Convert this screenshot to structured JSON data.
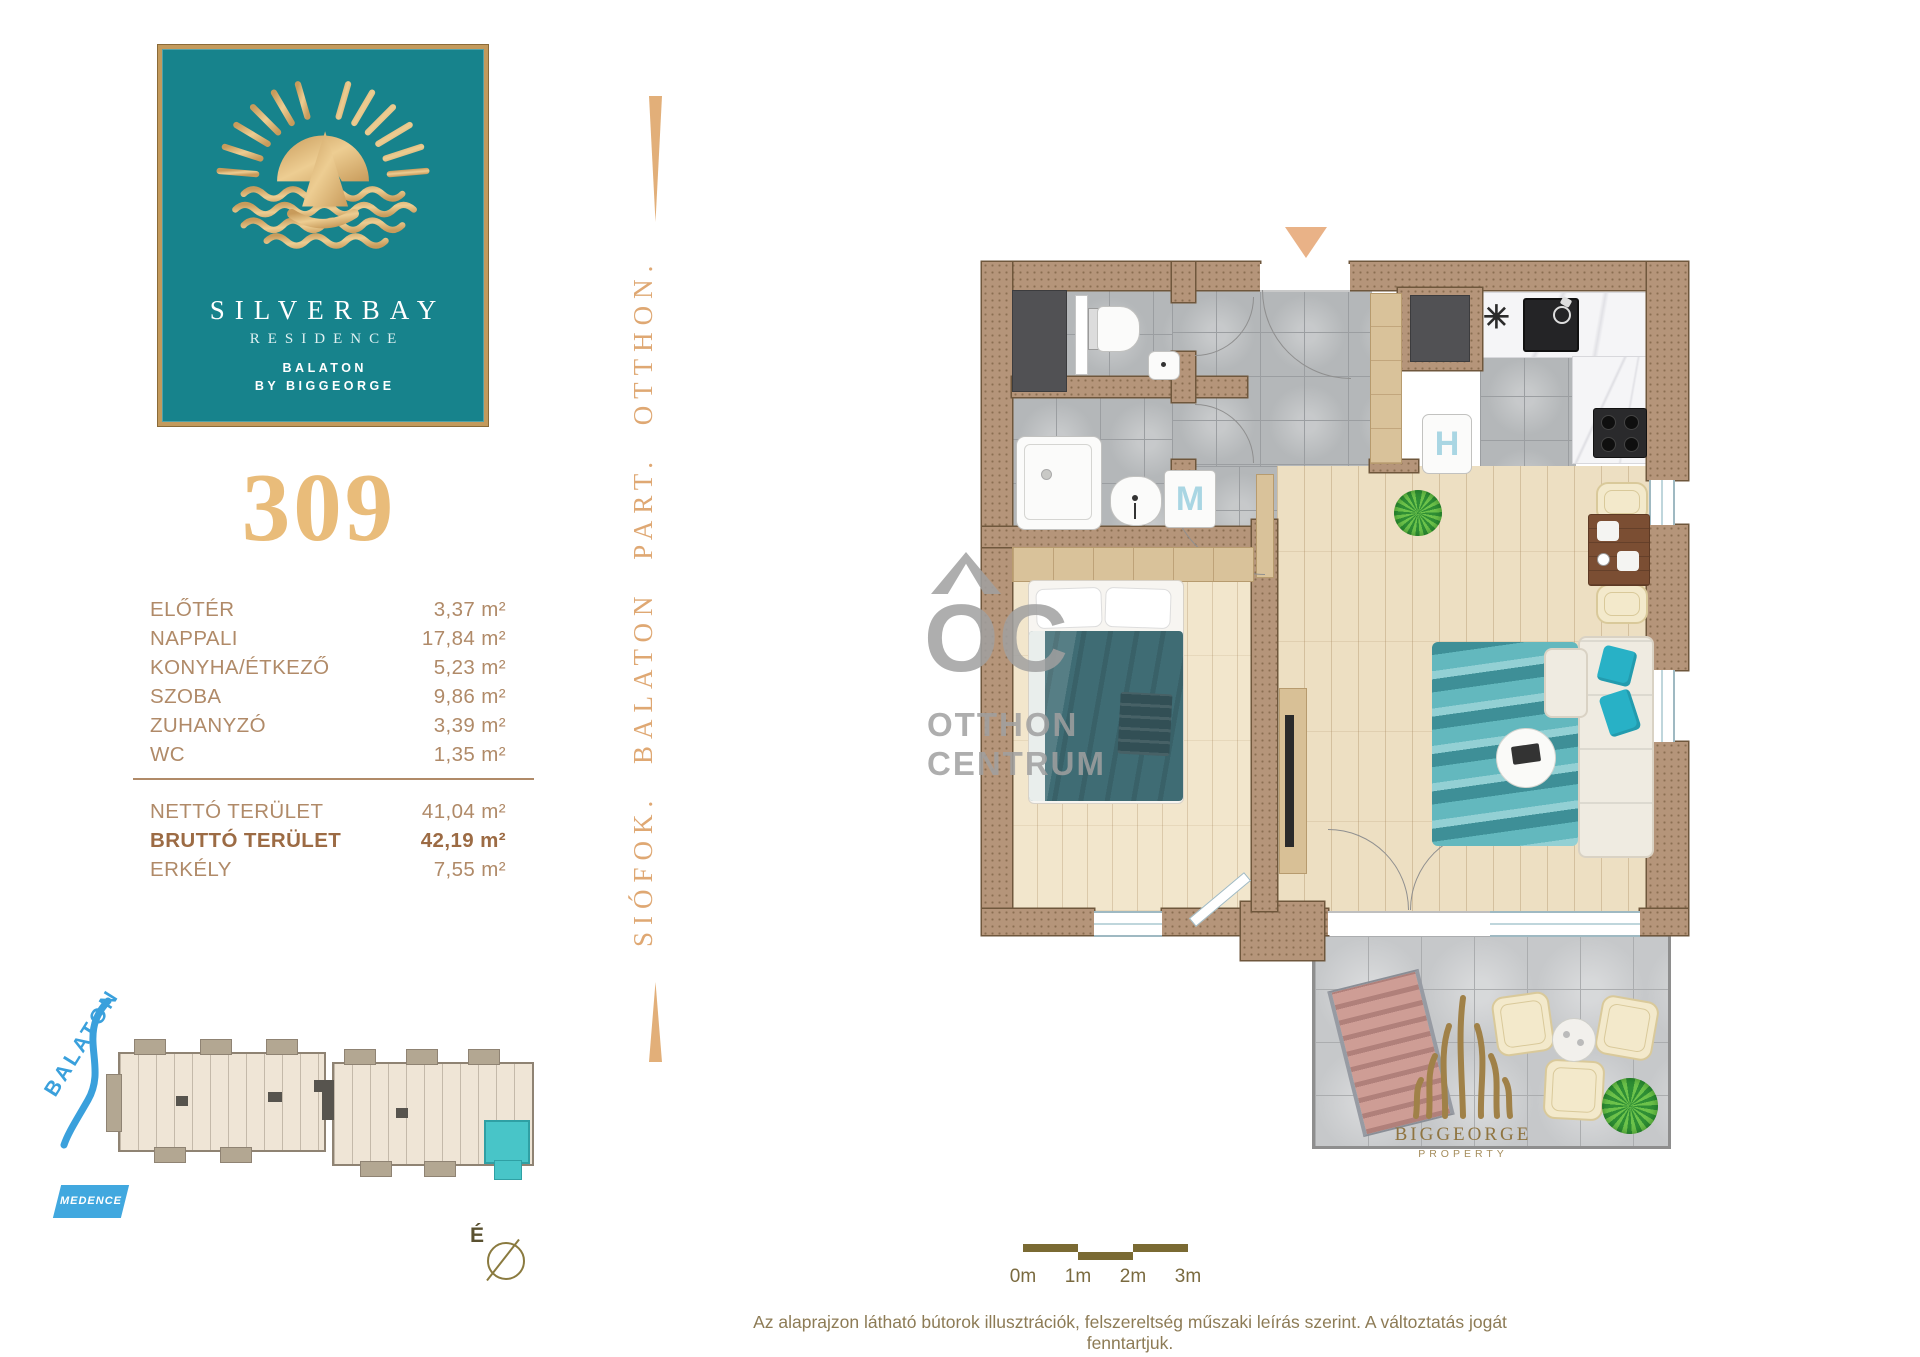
{
  "brand": {
    "logo_title": "SILVERBAY",
    "logo_sub": "RESIDENCE",
    "logo_line3": "BALATON",
    "logo_line4": "BY BIGGEORGE",
    "teal": "#17838C",
    "gold": "#E9BC7A",
    "side_text": "SIÓFOK.  BALATON PART.  OTTHON.",
    "footer_name": "BIGGEORGE",
    "footer_sub": "PROPERTY"
  },
  "unit": {
    "number": "309",
    "rooms": [
      {
        "label": "ELŐTÉR",
        "area": "3,37 m²"
      },
      {
        "label": "NAPPALI",
        "area": "17,84 m²"
      },
      {
        "label": "KONYHA/ÉTKEZŐ",
        "area": "5,23 m²"
      },
      {
        "label": "SZOBA",
        "area": "9,86 m²"
      },
      {
        "label": "ZUHANYZÓ",
        "area": "3,39 m²"
      },
      {
        "label": "WC",
        "area": "1,35 m²"
      }
    ],
    "totals": [
      {
        "label": "NETTÓ TERÜLET",
        "area": "41,04 m²",
        "bold": false
      },
      {
        "label": "BRUTTÓ TERÜLET",
        "area": "42,19 m²",
        "bold": true
      },
      {
        "label": "ERKÉLY",
        "area": "7,55 m²",
        "bold": false
      }
    ]
  },
  "site_plan": {
    "lake_label": "BALATON",
    "pool_label": "MEDENCE",
    "compass_label": "É",
    "highlight_color": "#48C5C8",
    "lake_blue": "#3AA0DC"
  },
  "floor_plan": {
    "fridge_label": "H",
    "washer_label": "M",
    "vent_symbol": "✳",
    "entry_arrow_color": "#E9B287"
  },
  "watermark": {
    "monogram": "OC",
    "line1": "OTTHON",
    "line2": "CENTRUM"
  },
  "scale_bar": {
    "labels": [
      "0m",
      "1m",
      "2m",
      "3m"
    ]
  },
  "disclaimer": "Az alaprajzon látható bútorok illusztrációk, felszereltség műszaki leírás szerint. A változtatás jogát fenntartjuk."
}
